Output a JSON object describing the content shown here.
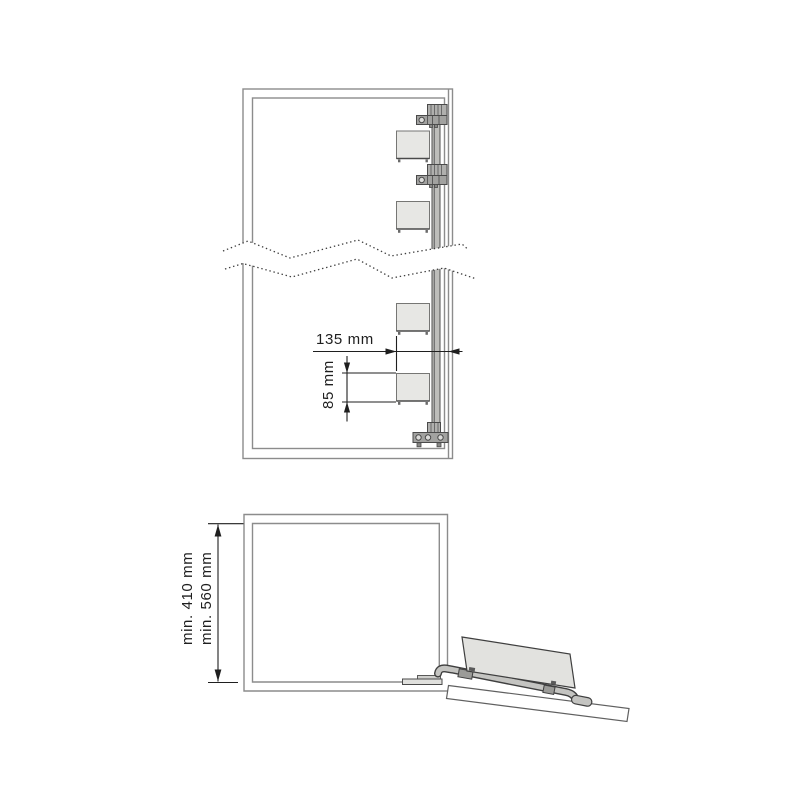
{
  "diagram": {
    "description": "Cabinet installation drawing: upper front view with mounting rail, clamp brackets and shelf supports; lower side view with minimum depth dimensions and pull-down tray mechanism",
    "colors": {
      "background": "#ffffff",
      "cabinet_line": "#8c8c8c",
      "hardware_line": "#3f3f3f",
      "hardware_fill": "#b5b5b2",
      "shelf_fill": "#e7e7e4",
      "dimension": "#1f1f1f"
    },
    "upper_view": {
      "dim_width_label": "135 mm",
      "dim_spacing_label": "85 mm",
      "shelf_support_count": 4,
      "bracket_count": 3
    },
    "lower_view": {
      "dim_min_1_label": "min. 410 mm",
      "dim_min_2_label": "min. 560 mm"
    }
  }
}
